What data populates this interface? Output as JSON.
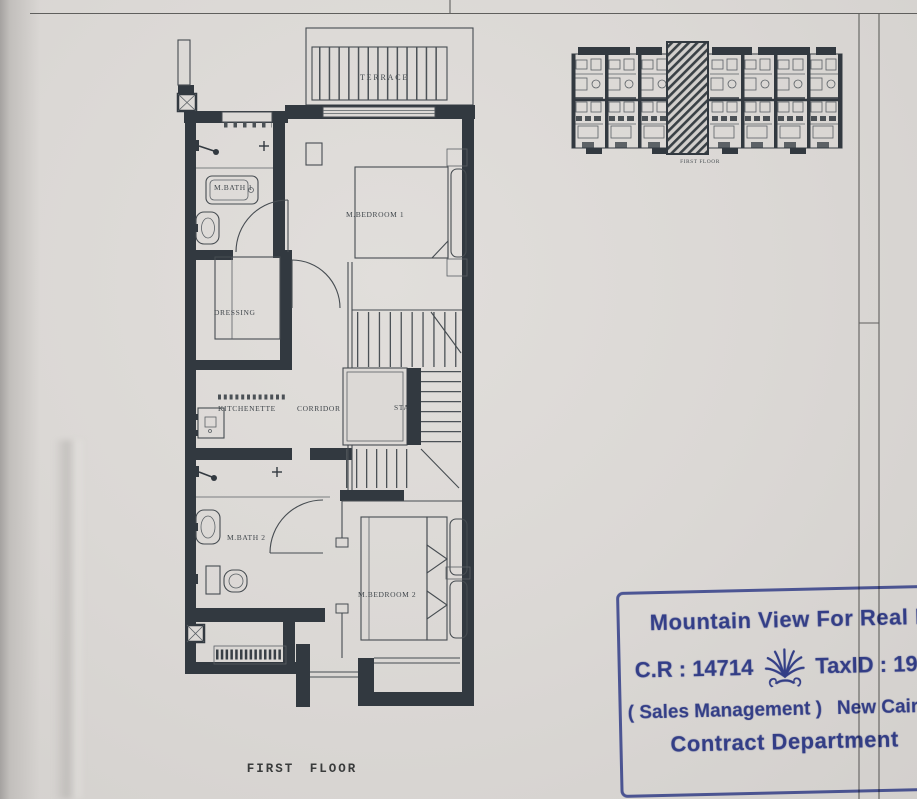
{
  "page": {
    "paper_color": "#dcd9d6",
    "ink_color": "#323940",
    "caption": "FIRST  FLOOR"
  },
  "floor_plan": {
    "rooms": {
      "terrace": "TERRACE",
      "mbedroom1": "M.BEDROOM 1",
      "mbath1": "M.BATH 1",
      "dressing": "DRESSING",
      "kitchenette": "KITCHENETTE",
      "corridor": "CORRIDOR",
      "stair": "STAIR",
      "mbath2": "M.BATH 2",
      "mbedroom2": "M.BEDROOM 2"
    }
  },
  "key_plan": {
    "caption": "FIRST FLOOR"
  },
  "stamp": {
    "company": "Mountain View For Real Estat",
    "cr": "C.R : 14714",
    "tax": "TaxID : 1978",
    "sales": "( Sales Management )",
    "branch": "New Cairo Branc",
    "department": "Contract Department",
    "ink_color": "#3c4aa4",
    "logo_icon": "palm-icon"
  }
}
